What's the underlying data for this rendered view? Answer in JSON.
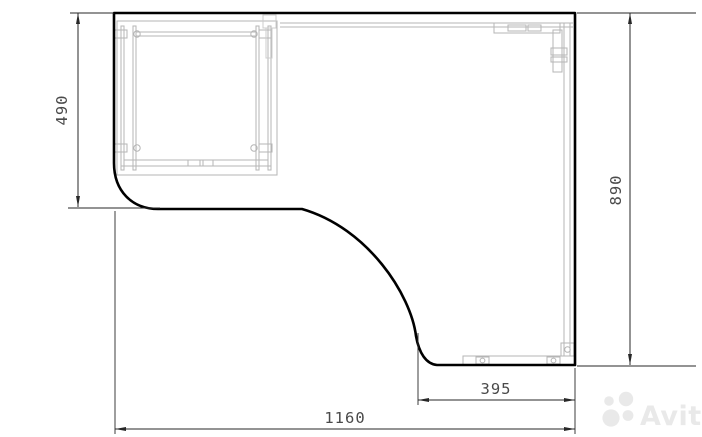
{
  "drawing": {
    "dimensions": {
      "left_depth": {
        "value": "490"
      },
      "right_depth": {
        "value": "890"
      },
      "return_width": {
        "value": "395"
      },
      "total_width": {
        "value": "1160"
      }
    }
  },
  "watermark": {
    "text": "Avito"
  },
  "colors": {
    "background": "#ffffff",
    "outline": "#000000",
    "dimension": "#272727",
    "label": "#4a4a4a",
    "detail": "#b5b5b5",
    "detail_light": "#cccccc",
    "watermark": "#e9e9e9"
  }
}
